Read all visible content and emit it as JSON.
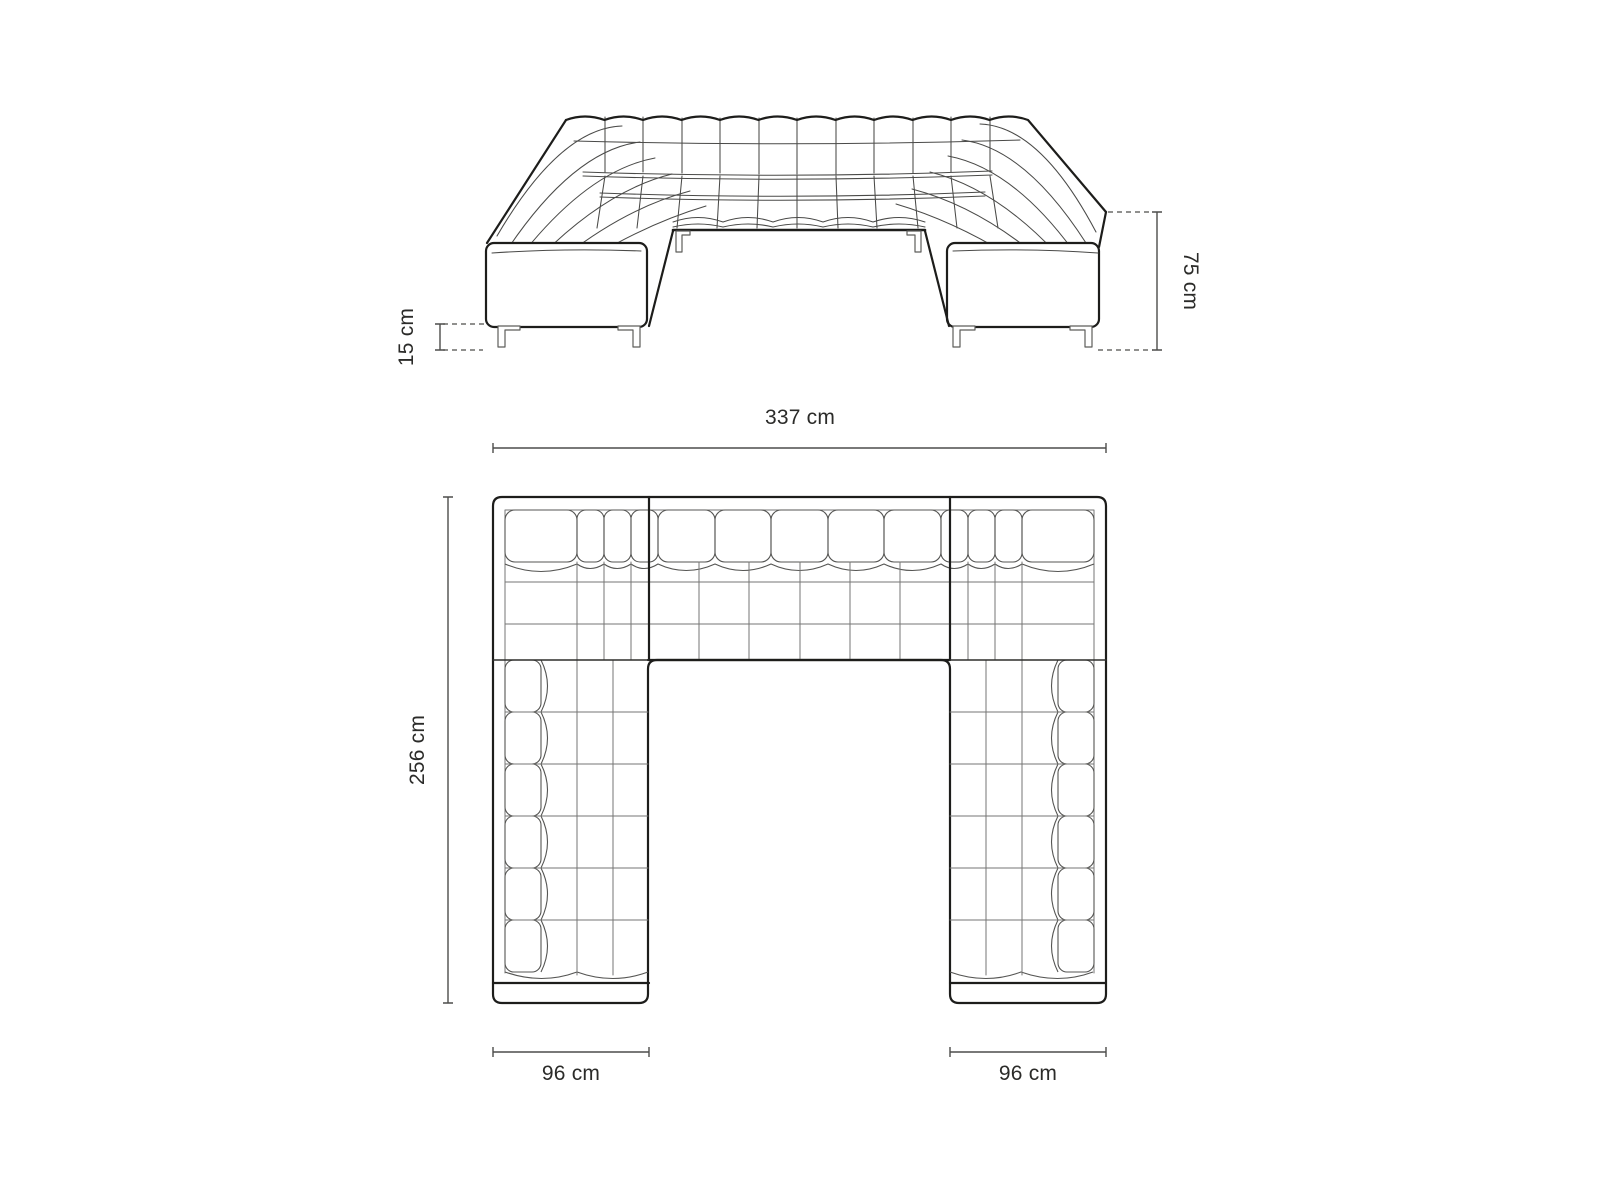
{
  "diagram": {
    "title": "u-shaped-sofa-dimension-diagram",
    "front_view": {
      "height_label": "75 cm",
      "leg_height_label": "15 cm"
    },
    "top_view": {
      "width_label": "337 cm",
      "depth_label": "256 cm",
      "left_arm_width_label": "96 cm",
      "right_arm_width_label": "96 cm"
    },
    "colors": {
      "background": "#ffffff",
      "outline": "#1d1d1b",
      "detail_lines": "#4a4a48",
      "dimension_lines": "#4d4d4b",
      "label_text": "#2b2b29"
    }
  }
}
